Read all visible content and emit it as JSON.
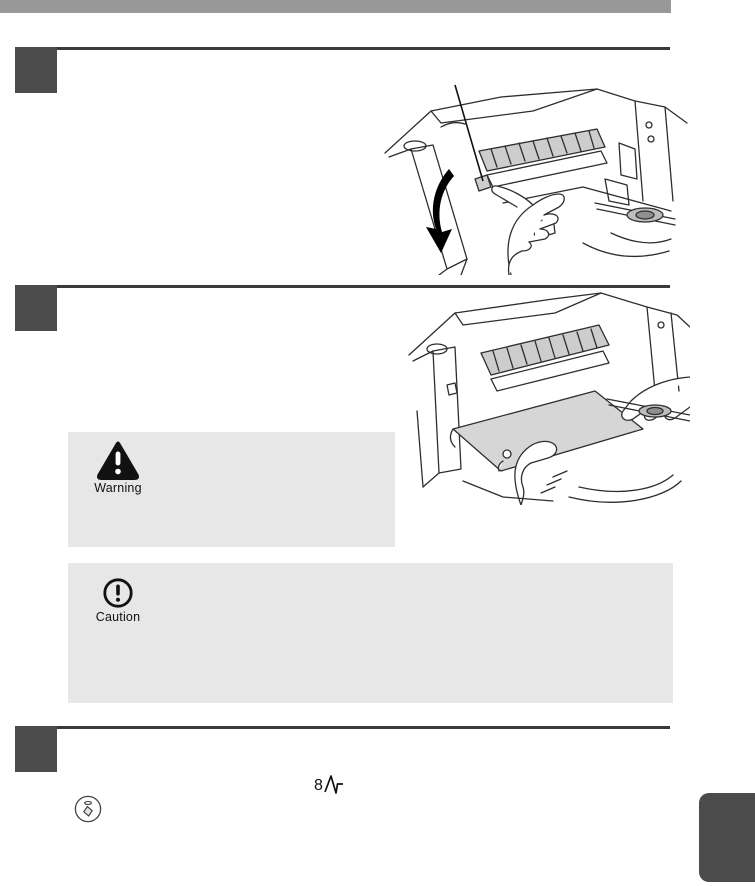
{
  "document": {
    "kind": "copier manual page (misfeed removal)",
    "background_color": "#ffffff",
    "body_text": ""
  },
  "header": {
    "bar_color": "#989898"
  },
  "colors": {
    "rule": "#3a3a3a",
    "step_number_box": "#4b4b4b",
    "notice_background": "#e7e7e7",
    "chapter_tab": "#4b4b4b",
    "line_art_stroke": "#2e2e2e",
    "shaded_part_fill": "#cdcdcd"
  },
  "steps": [
    {
      "name": "step-1",
      "figure": "hand-rotating-fusing-unit-roller-with-down-arrow-and-callout-line"
    },
    {
      "name": "step-2",
      "figure": "hands-removing-jammed-paper-sheet"
    },
    {
      "name": "step-3",
      "figure": "jam-indicator-and-start-key-symbols"
    }
  ],
  "notices": {
    "warning": {
      "label": "Warning",
      "icon": "warning-triangle-icon"
    },
    "caution": {
      "label": "Caution",
      "icon": "caution-circle-icon"
    }
  },
  "symbols": {
    "jam_indicator_digit": "8",
    "jam_indicator_icon": "zigzag-misfeed-mark",
    "start_key_icon": "circle-with-diamond-and-led"
  }
}
